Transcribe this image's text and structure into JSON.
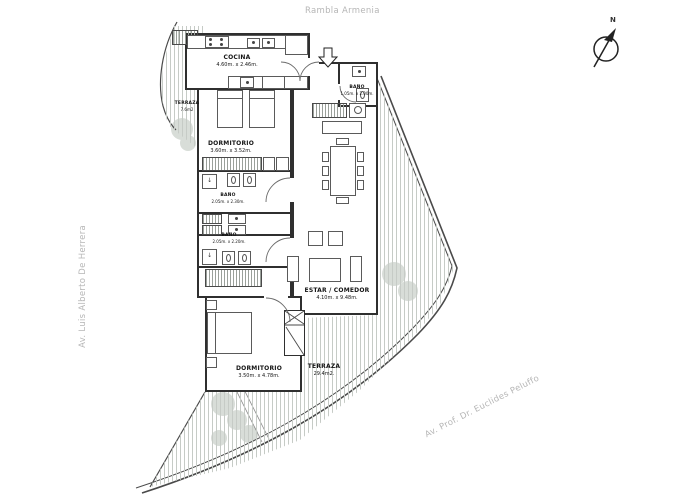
{
  "streets": {
    "top": "Rambla Armenia",
    "left": "Av. Luis Alberto De Herrera",
    "bottom_right": "Av. Prof. Dr. Euclides Peluffo"
  },
  "compass": {
    "label": "N"
  },
  "rooms": {
    "cocina": {
      "name": "COCINA",
      "dims": "4.60m. x 2.46m."
    },
    "terraza_norte": {
      "name": "TERRAZA",
      "dims": "7.6m2"
    },
    "dormitorio_1": {
      "name": "DORMITORIO",
      "dims": "3.60m. x 3.52m."
    },
    "bano_1": {
      "name": "BAÑO",
      "dims": "2.05m. x 2.30m."
    },
    "bano_2": {
      "name": "BAÑO",
      "dims": "2.05m. x 2.20m."
    },
    "bano_servicio": {
      "name": "BAÑO",
      "dims": "1.05m. x 2.00m."
    },
    "estar_comedor": {
      "name": "ESTAR / COMEDOR",
      "dims": "4.10m. x 9.48m."
    },
    "dormitorio_2": {
      "name": "DORMITORIO",
      "dims": "3.50m. x 4.78m."
    },
    "terraza_sur": {
      "name": "TERRAZA",
      "dims": "29.4m2."
    }
  },
  "icons": {
    "compass": "compass-north-arrow",
    "entrance": "entrance-arrow-down",
    "shower_glyph": "↓"
  },
  "colors": {
    "wall": "#2f2f2f",
    "furniture": "#5a5a5a",
    "hatch": "#c6cbc6",
    "street_text": "#b6b6b6",
    "tree": "#d8ddd8"
  }
}
